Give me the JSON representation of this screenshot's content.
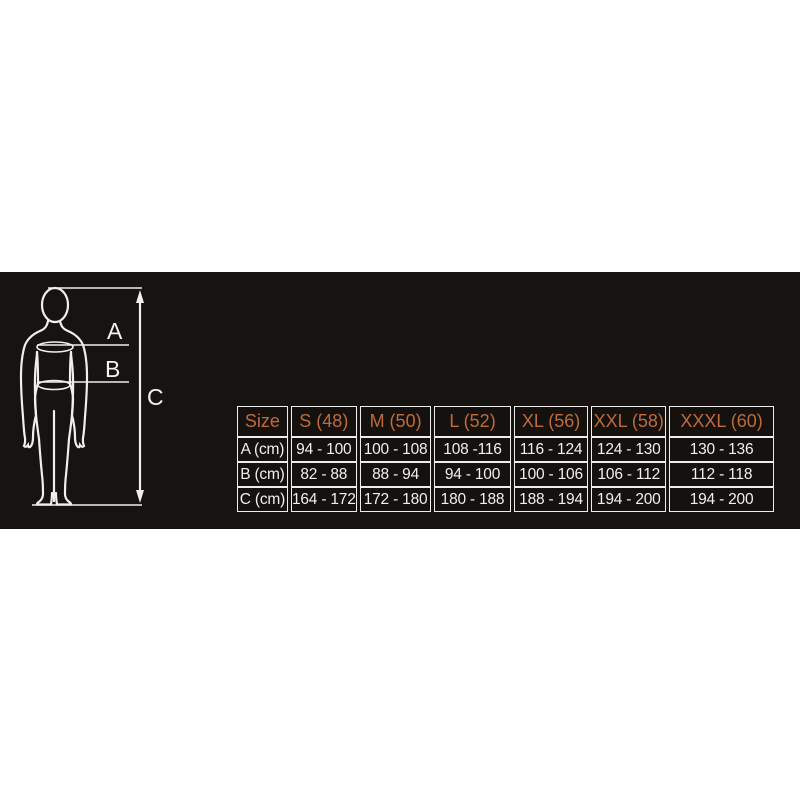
{
  "colors": {
    "page_background": "#ffffff",
    "band_background": "#161310",
    "line_color": "#efefef",
    "header_accent": "#bf6b3a",
    "cell_text": "#f0f0f0"
  },
  "diagram": {
    "labels": {
      "a": "A",
      "b": "B",
      "c": "C"
    }
  },
  "table": {
    "header": [
      "Size",
      "S (48)",
      "M (50)",
      "L (52)",
      "XL (56)",
      "XXL (58)",
      "XXXL (60)"
    ],
    "rows": [
      {
        "label": "A (cm)",
        "values": [
          "94 - 100",
          "100 - 108",
          "108 -116",
          "116 - 124",
          "124 - 130",
          "130 - 136"
        ]
      },
      {
        "label": "B (cm)",
        "values": [
          "82 - 88",
          "88 - 94",
          "94 - 100",
          "100 - 106",
          "106 - 112",
          "112 - 118"
        ]
      },
      {
        "label": "C (cm)",
        "values": [
          "164 - 172",
          "172 - 180",
          "180 - 188",
          "188 - 194",
          "194 - 200",
          "194 - 200"
        ]
      }
    ]
  }
}
